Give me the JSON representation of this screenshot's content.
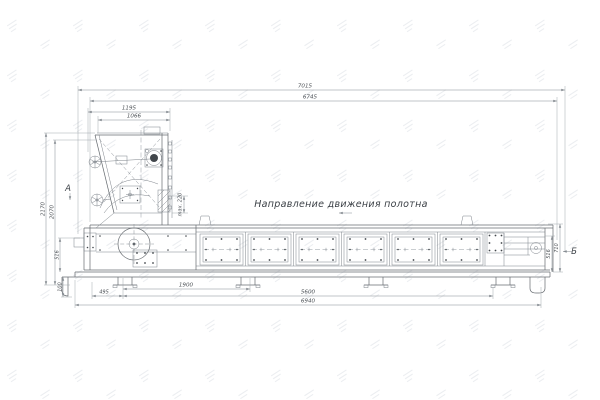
{
  "page": {
    "background": "#ffffff",
    "line_color": "#666b70",
    "dim_color": "#858b91",
    "text_color": "#4c5156"
  },
  "labels": {
    "direction": "Направление движения полотна",
    "view_a": "А",
    "view_b": "Б"
  },
  "dims": {
    "overall_length": "7015",
    "frame_length": "6745",
    "hopper_outer": "1195",
    "hopper_inner": "1066",
    "overall_height": "2170",
    "hopper_height": "2070",
    "frame_height_left": "516",
    "ground_clearance": "100",
    "gate_opening": "max. 220",
    "frame_height_right": "516",
    "belt_height": "710",
    "leg_pitch": "1900",
    "end_offset": "495",
    "support_span": "5600",
    "base_length": "6940"
  }
}
